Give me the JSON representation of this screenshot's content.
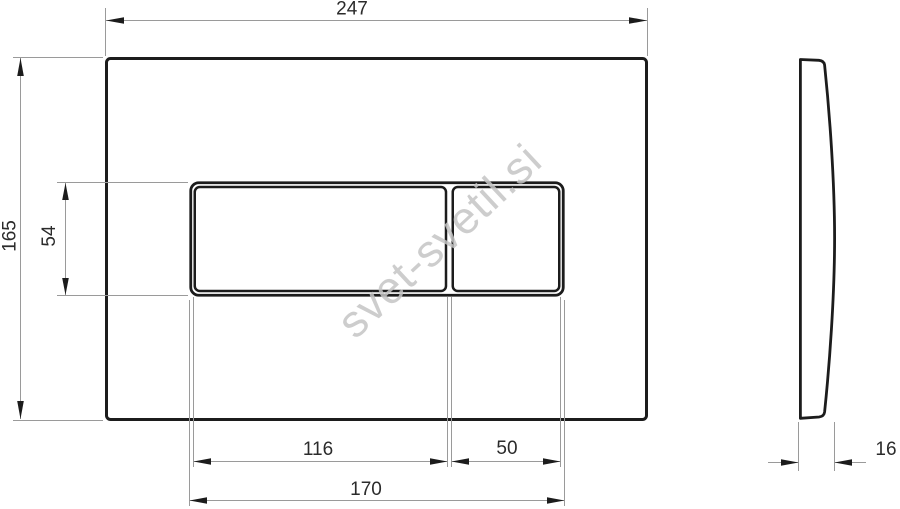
{
  "watermark": {
    "text": "svet-svetil.si",
    "color": "#c5c5c5"
  },
  "dimensions": {
    "overall_width": "247",
    "overall_height": "165",
    "button_area_height": "54",
    "large_button_width": "116",
    "small_button_width": "50",
    "button_area_width": "170",
    "side_thickness": "16"
  },
  "colors": {
    "outline": "#1c1c1c",
    "dimension_line": "#9a9a9a",
    "label_text": "#2b2b2b",
    "background": "#ffffff"
  }
}
